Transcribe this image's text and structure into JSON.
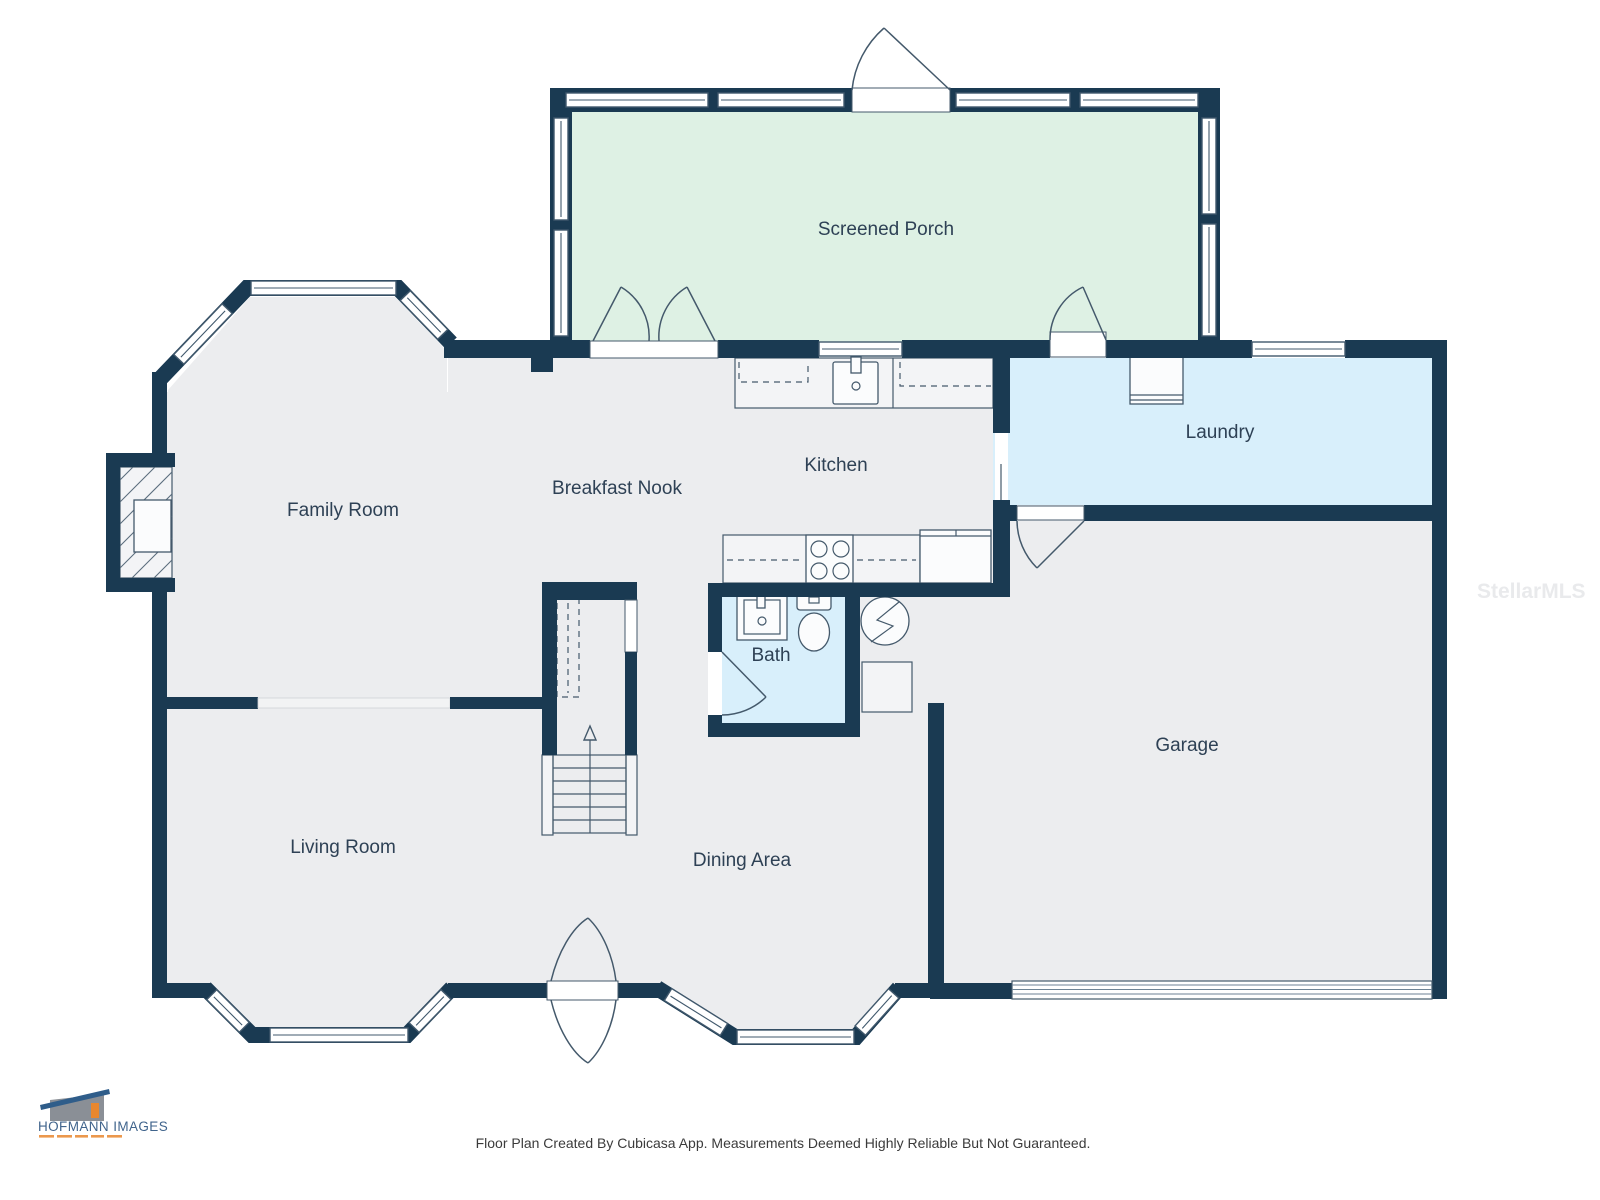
{
  "page": {
    "background": "#ffffff"
  },
  "colors": {
    "wall": "#1a3a52",
    "floor": "#ecedef",
    "porch_floor": "#def1e4",
    "wet_room_floor": "#d8effb",
    "label_text": "#2e4155",
    "logo_roof": "#2f5d8a",
    "logo_wall": "#8a8f96",
    "logo_accent": "#e8872e"
  },
  "rooms": {
    "screened_porch": {
      "label": "Screened Porch"
    },
    "family_room": {
      "label": "Family Room"
    },
    "breakfast_nook": {
      "label": "Breakfast Nook"
    },
    "kitchen": {
      "label": "Kitchen"
    },
    "laundry": {
      "label": "Laundry"
    },
    "bath": {
      "label": "Bath"
    },
    "garage": {
      "label": "Garage"
    },
    "living_room": {
      "label": "Living Room"
    },
    "dining_area": {
      "label": "Dining Area"
    }
  },
  "fixtures": [
    "fireplace",
    "stairs-up",
    "kitchen-sink",
    "stove-4-burner",
    "refrigerator",
    "washer",
    "water-heater",
    "bath-sink",
    "toilet",
    "garage-door",
    "bay-windows"
  ],
  "logo": {
    "brand": "HOFMANN IMAGES"
  },
  "watermark": {
    "text": "StellarMLS"
  },
  "footer": {
    "disclaimer": "Floor Plan Created By Cubicasa App. Measurements Deemed Highly Reliable But Not Guaranteed."
  }
}
